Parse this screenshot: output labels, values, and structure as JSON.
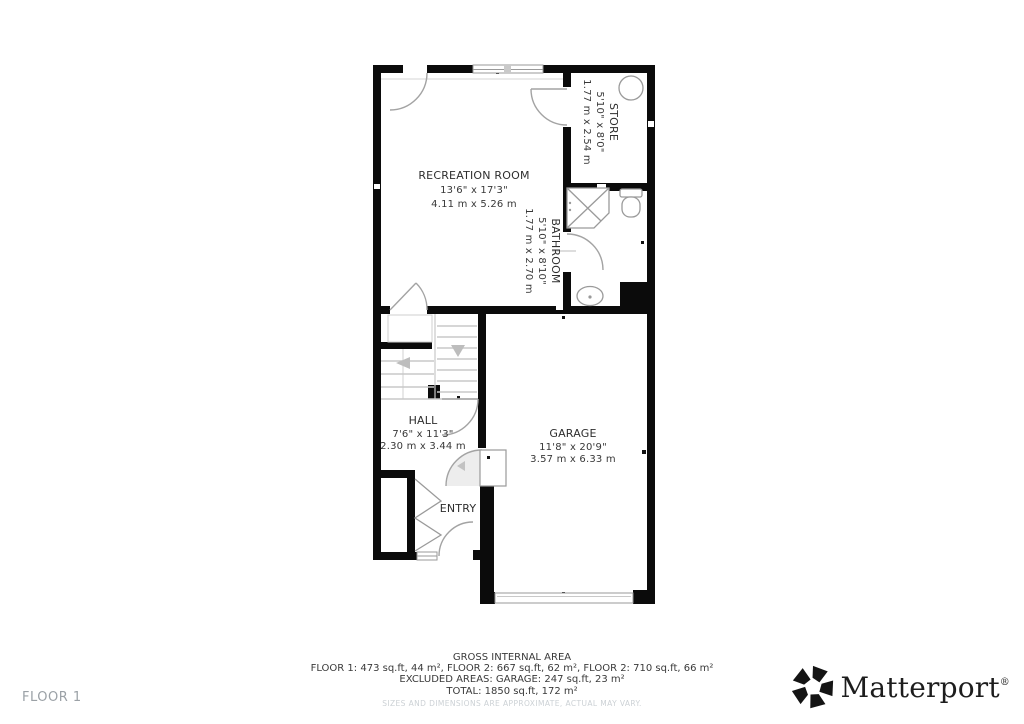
{
  "floor_label": "FLOOR 1",
  "rooms": {
    "recreation": {
      "name": "RECREATION ROOM",
      "imperial": "13'6\" x 17'3\"",
      "metric": "4.11 m x 5.26 m"
    },
    "store": {
      "name": "STORE",
      "imperial": "5'10\" x 8'0\"",
      "metric": "1.77 m x 2.54 m"
    },
    "bathroom": {
      "name": "BATHROOM",
      "imperial": "5'10\" x 8'10\"",
      "metric": "1.77 m x 2.70 m"
    },
    "hall": {
      "name": "HALL",
      "imperial": "7'6\" x 11'3\"",
      "metric": "2.30 m x 3.44 m"
    },
    "entry": {
      "name": "ENTRY"
    },
    "garage": {
      "name": "GARAGE",
      "imperial": "11'8\" x 20'9\"",
      "metric": "3.57 m x 6.33 m"
    }
  },
  "footer": {
    "title": "GROSS INTERNAL AREA",
    "line1": "FLOOR 1: 473 sq.ft, 44 m², FLOOR 2: 667 sq.ft, 62 m², FLOOR 2: 710 sq.ft, 66 m²",
    "line2": "EXCLUDED AREAS: GARAGE: 247 sq.ft, 23 m²",
    "line3": "TOTAL: 1850 sq.ft, 172 m²",
    "disclaimer": "SIZES AND DIMENSIONS ARE APPROXIMATE, ACTUAL MAY VARY."
  },
  "brand": {
    "name": "Matterport",
    "registered": "®"
  },
  "colors": {
    "wall": "#0b0b0b",
    "fixture_stroke": "#9a9a9a",
    "tread": "#c8c8c8",
    "label": "#2e2e2e"
  }
}
